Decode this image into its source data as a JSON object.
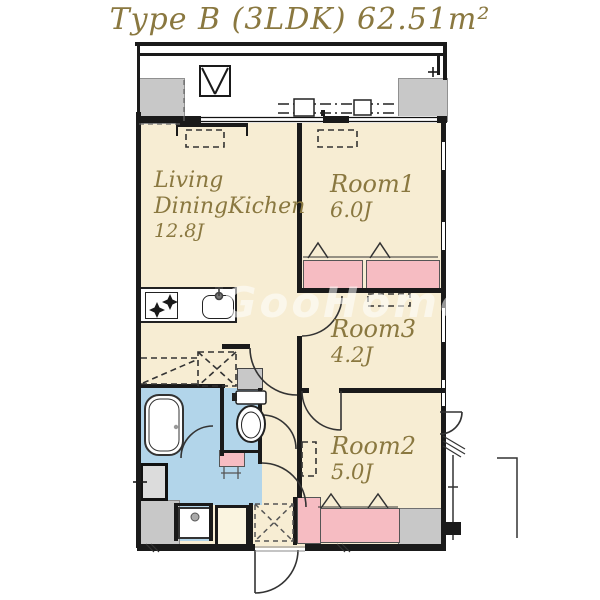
{
  "title": "Type B (3LDK) 62.51m²",
  "watermark": "GooHome",
  "colors": {
    "label_text": "#8a7840",
    "room_fill": "#f7edd3",
    "closet_fill": "#f6bcc2",
    "wet_area_fill": "#b2d5ea",
    "pillar_fill": "#c8c8c8",
    "wall": "#1a1a1a"
  },
  "rooms": {
    "ldk": {
      "label_line1": "Living",
      "label_line2": "DiningKichen",
      "size": "12.8J"
    },
    "room1": {
      "label": "Room1",
      "size": "6.0J"
    },
    "room3": {
      "label": "Room3",
      "size": "4.2J"
    },
    "room2": {
      "label": "Room2",
      "size": "5.0J"
    }
  },
  "fixtures": {
    "bathtub": "bathtub-icon",
    "toilet": "toilet-icon",
    "kitchen_stove": "gas-stove-icon",
    "kitchen_sink": "sink-icon",
    "washing_machine_pan": "washing-machine-pan-icon",
    "ac_outdoor_unit": "ac-outdoor-unit-icon",
    "refrigerator_space": "refrigerator-dashed-box",
    "meter_box": "meter-box-icon",
    "shoe_cabinet": "shoe-cabinet-dashed-box"
  }
}
